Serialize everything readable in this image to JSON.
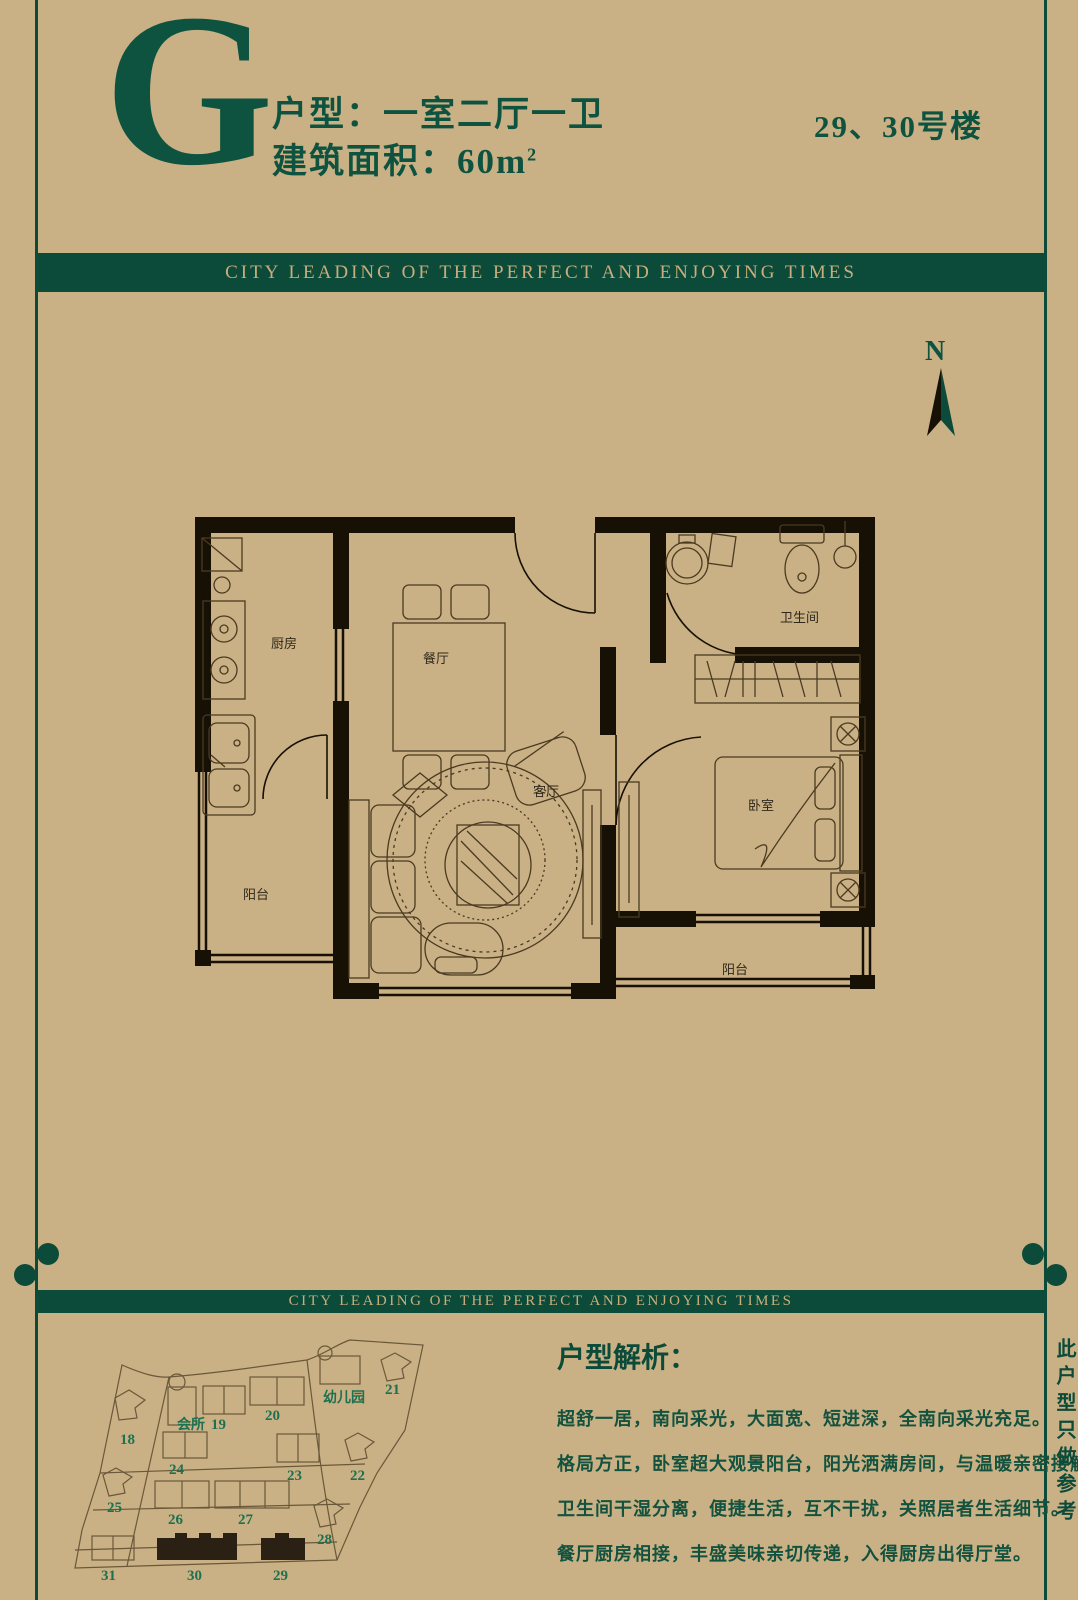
{
  "palette": {
    "background": "#c9b185",
    "accent_green": "#0c4a39",
    "text_green": "#0e5340",
    "bar_text": "#c7ae7c",
    "wall_black": "#171004",
    "plan_line": "#4a3a22",
    "site_line": "#6a583a",
    "site_label_green": "#1e7050"
  },
  "header": {
    "unit_letter": "G",
    "unit_type_line": "户型：一室二厅一卫",
    "area_label": "建筑面积：",
    "area_value": "60",
    "area_unit_base": "m",
    "area_unit_sup": "2",
    "building_no": "29、30号楼"
  },
  "banner": {
    "top_text": "CITY LEADING OF THE PERFECT AND ENJOYING TIMES",
    "bottom_text": "CITY LEADING OF THE PERFECT AND ENJOYING TIMES"
  },
  "compass": {
    "label": "N"
  },
  "floor_plan": {
    "kitchen": "厨房",
    "dining": "餐厅",
    "balcony_left": "阳台",
    "living": "客厅",
    "bath": "卫生间",
    "bedroom": "卧室",
    "balcony_bottom": "阳台"
  },
  "site_plan": {
    "clubhouse": "会所",
    "kindergarten": "幼儿园",
    "highlighted": [
      "29",
      "30"
    ],
    "buildings": [
      {
        "label": "18"
      },
      {
        "label": "19"
      },
      {
        "label": "20"
      },
      {
        "label": "21"
      },
      {
        "label": "22"
      },
      {
        "label": "23"
      },
      {
        "label": "24"
      },
      {
        "label": "25"
      },
      {
        "label": "26"
      },
      {
        "label": "27"
      },
      {
        "label": "28"
      },
      {
        "label": "29"
      },
      {
        "label": "30"
      },
      {
        "label": "31"
      }
    ]
  },
  "analysis": {
    "heading": "户型解析：",
    "lines": [
      "超舒一居，南向采光，大面宽、短进深，全南向采光充足。",
      "格局方正，卧室超大观景阳台，阳光洒满房间，与温暖亲密接触。",
      "卫生间干湿分离，便捷生活，互不干扰，关照居者生活细节。",
      "餐厅厨房相接，丰盛美味亲切传递，入得厨房出得厅堂。"
    ]
  },
  "side_note": "此户型只做参考"
}
